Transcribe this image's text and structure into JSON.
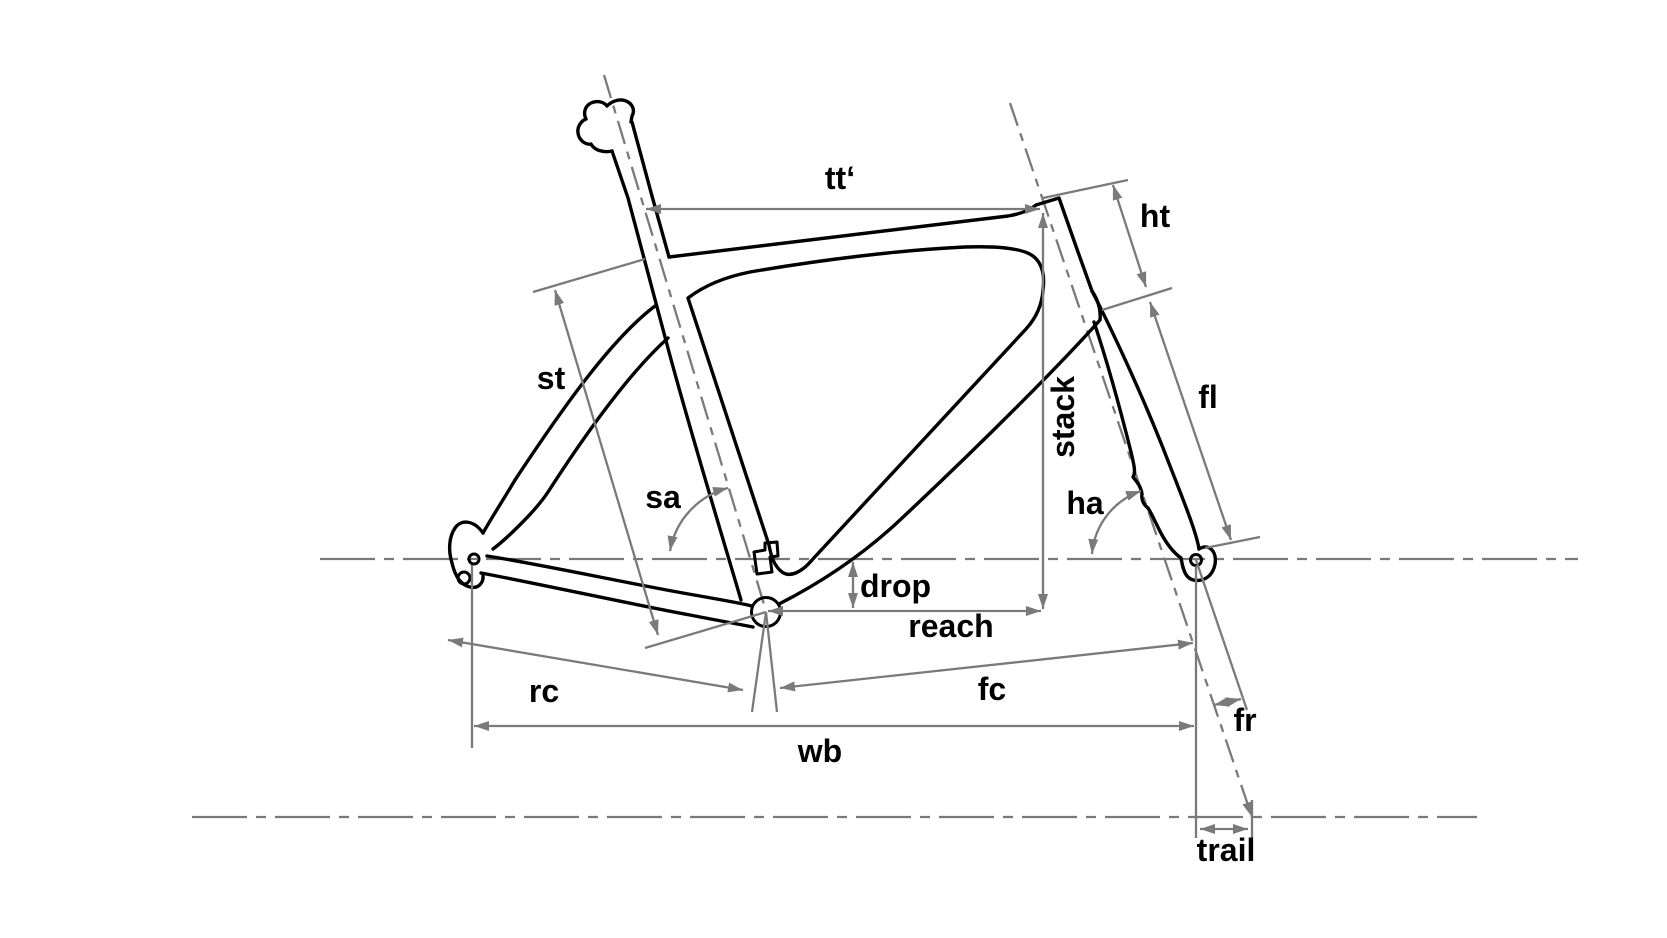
{
  "diagram": {
    "type": "bicycle-frame-geometry-diagram",
    "description": "Line drawing of a road bike frame and fork with geometry dimension annotations",
    "labels": {
      "tt": "tt‘",
      "ht": "ht",
      "fl": "fl",
      "st": "st",
      "stack": "stack",
      "sa": "sa",
      "ha": "ha",
      "drop": "drop",
      "reach": "reach",
      "rc": "rc",
      "fc": "fc",
      "wb": "wb",
      "fr": "fr",
      "trail": "trail"
    },
    "colors": {
      "background": "#ffffff",
      "frame_outline": "#000000",
      "dimension_lines": "#7a7a7a",
      "label_text": "#000000"
    }
  }
}
